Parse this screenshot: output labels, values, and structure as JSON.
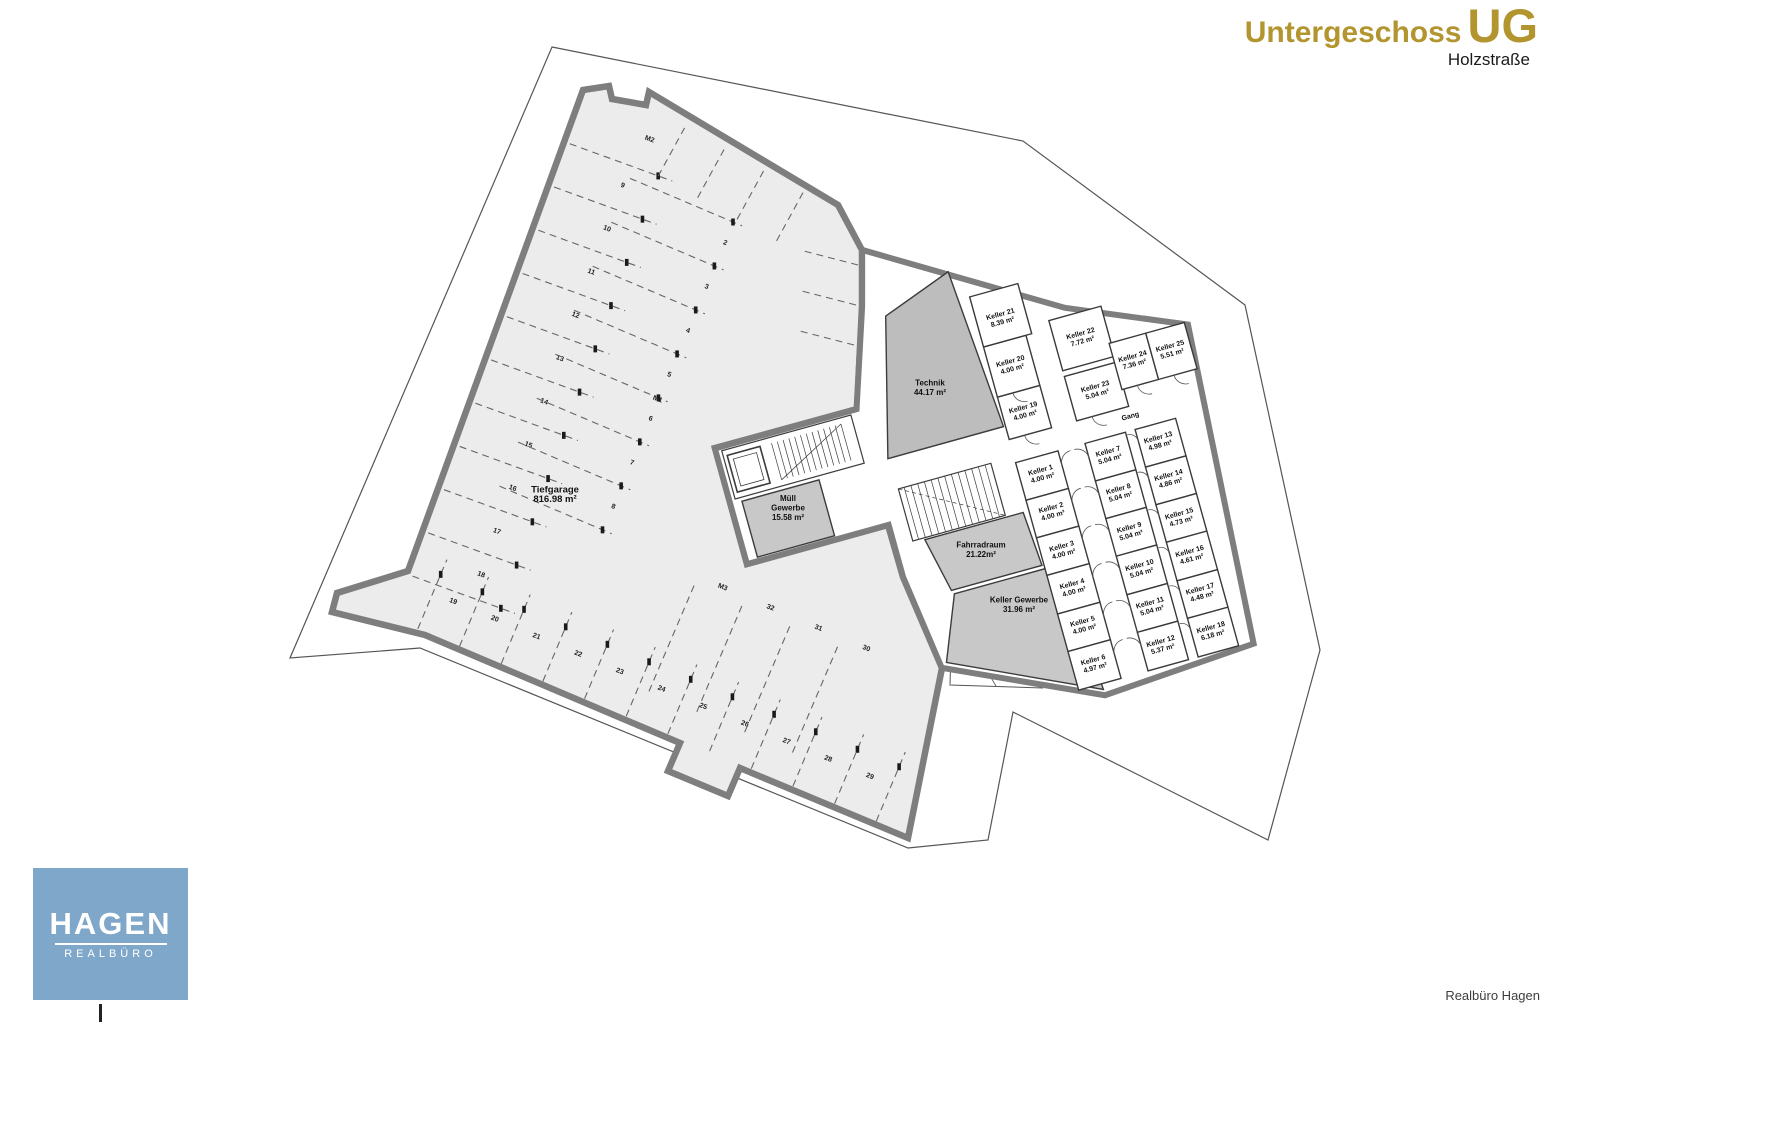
{
  "title": {
    "main": "Untergeschoss",
    "abbr": "UG",
    "subtitle": "Holzstraße"
  },
  "logo": {
    "name": "HAGEN",
    "sub": "REALBÜRO"
  },
  "credit": "Realbüro Hagen",
  "colors": {
    "accent_gold": "#b2952e",
    "logo_blue": "#7fa7c9",
    "wall_gray": "#7e7e7e",
    "garage_fill": "#ececec",
    "technik_fill": "#bdbdbd",
    "service_fill": "#c8c8c8"
  },
  "plan": {
    "rooms_rotated": [
      {
        "name": "Keller 1",
        "area": "4.00 m²",
        "x": -4,
        "y": -1
      },
      {
        "name": "Keller 2",
        "area": "4.00 m²",
        "x": -4,
        "y": 38
      },
      {
        "name": "Keller 3",
        "area": "4.00 m²",
        "x": -4,
        "y": 78
      },
      {
        "name": "Keller 4",
        "area": "4.00 m²",
        "x": -4,
        "y": 117
      },
      {
        "name": "Keller 5",
        "area": "4.00 m²",
        "x": -4,
        "y": 156
      },
      {
        "name": "Keller 6",
        "area": "4.97 m²",
        "x": -4,
        "y": 196
      },
      {
        "name": "Keller 7",
        "area": "5.04 m²",
        "x": 66,
        "y": -1
      },
      {
        "name": "Keller 8",
        "area": "5.04 m²",
        "x": 66,
        "y": 38
      },
      {
        "name": "Keller 9",
        "area": "5.04 m²",
        "x": 66,
        "y": 78
      },
      {
        "name": "Keller 10",
        "area": "5.04 m²",
        "x": 66,
        "y": 117
      },
      {
        "name": "Keller 11",
        "area": "5.04 m²",
        "x": 66,
        "y": 156
      },
      {
        "name": "Keller 12",
        "area": "5.37 m²",
        "x": 66,
        "y": 196
      },
      {
        "name": "Keller 13",
        "area": "4.98 m²",
        "x": 118,
        "y": -1
      },
      {
        "name": "Keller 14",
        "area": "4.86 m²",
        "x": 118,
        "y": 38
      },
      {
        "name": "Keller 15",
        "area": "4.73 m²",
        "x": 118,
        "y": 78
      },
      {
        "name": "Keller 16",
        "area": "4.61 m²",
        "x": 118,
        "y": 117
      },
      {
        "name": "Keller 17",
        "area": "4.48 m²",
        "x": 118,
        "y": 156
      },
      {
        "name": "Keller 18",
        "area": "6.18 m²",
        "x": 118,
        "y": 196
      },
      {
        "name": "Keller 19",
        "area": "4.00 m²",
        "x": -4,
        "y": -66
      },
      {
        "name": "Keller 20",
        "area": "4.00 m²",
        "x": -4,
        "y": -114
      },
      {
        "name": "Keller 21",
        "area": "8.39 m²",
        "x": -1,
        "y": -162
      },
      {
        "name": "Keller 22",
        "area": "7.72 m²",
        "x": 71,
        "y": -122
      },
      {
        "name": "Keller 23",
        "area": "5.04 m²",
        "x": 71,
        "y": -67
      },
      {
        "name": "Keller 24",
        "area": "7.36 m²",
        "x": 115,
        "y": -86
      },
      {
        "name": "Keller 25",
        "area": "5.51 m²",
        "x": 154,
        "y": -86
      },
      {
        "name": "Gang",
        "area": "",
        "x": 97,
        "y": -32
      }
    ],
    "rooms_fixed": [
      {
        "id": "tiefgarage",
        "name": "Tiefgarage",
        "area": "816.98 m²",
        "x": 555,
        "y": 497,
        "big": true
      },
      {
        "id": "technik",
        "name": "Technik",
        "area": "44.17 m²",
        "x": 930,
        "y": 390
      },
      {
        "id": "muell-gewerbe",
        "name": "Müll Gewerbe",
        "area": "15.58 m²",
        "x": 788,
        "y": 510,
        "threeLines": true
      },
      {
        "id": "fahrradraum",
        "name": "Fahrradraum",
        "area": "21.22m²",
        "x": 981,
        "y": 552
      },
      {
        "id": "keller-gewerbe",
        "name": "Keller Gewerbe",
        "area": "31.96 m²",
        "x": 1019,
        "y": 607
      }
    ],
    "parking": {
      "left": [
        "9",
        "10",
        "11",
        "12",
        "13",
        "14",
        "15",
        "16",
        "17",
        "18"
      ],
      "middle": [
        "2",
        "3",
        "4",
        "5",
        "6",
        "7",
        "8"
      ],
      "bottom": [
        "19",
        "20",
        "21",
        "22",
        "23",
        "24",
        "25",
        "26",
        "27",
        "28",
        "29"
      ],
      "right": [
        "32",
        "31",
        "30"
      ],
      "moto": [
        "M1",
        "M2",
        "M3"
      ]
    }
  }
}
